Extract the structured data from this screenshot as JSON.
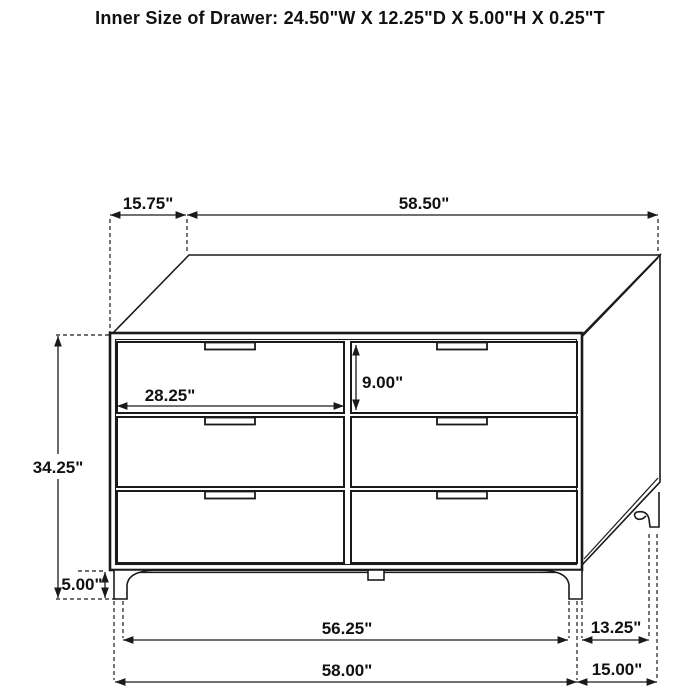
{
  "title": "Inner Size of Drawer: 24.50\"W X 12.25\"D X 5.00\"H X 0.25\"T",
  "dimensions": {
    "top_depth": "15.75\"",
    "top_width": "58.50\"",
    "overall_height": "34.25\"",
    "leg_height": "5.00\"",
    "drawer_front_width": "28.25\"",
    "drawer_front_height": "9.00\"",
    "leg_span_inner": "56.25\"",
    "overall_width": "58.00\"",
    "side_leg_span": "13.25\"",
    "overall_depth": "15.00\""
  },
  "colors": {
    "line": "#1a1a1a",
    "background": "#ffffff"
  }
}
